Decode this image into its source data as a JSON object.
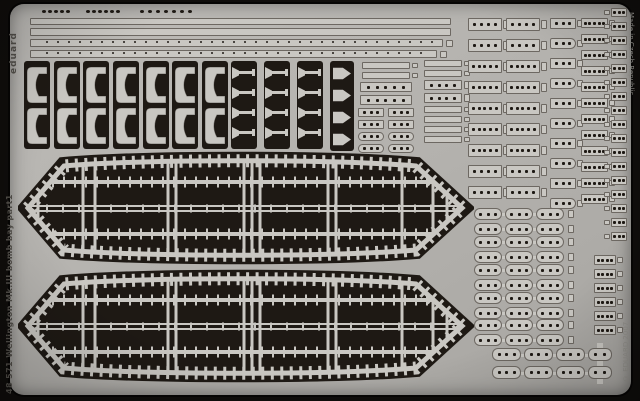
{
  "texts": {
    "brand": "eduard",
    "sheet_label": "48 571  Wellington Mk.III bomb bay   part1",
    "made_in": "Made in Czech Republic",
    "copyright": "© EDUARD 2007"
  },
  "colors": {
    "background": "#0f0d0b",
    "metal": "#b3b1ad",
    "metal_light": "#bdbbb7",
    "metal_dark": "#a7a5a1",
    "part": "#c9c7c2",
    "etch": "#1e1914",
    "outline": "rgba(32,26,20,0.55)",
    "text_dark": "#504d48",
    "text_light": "#8f8d88"
  },
  "parts": {
    "dot_groups": [
      {
        "x": 42,
        "y": 10,
        "count": 5,
        "dx": 6
      },
      {
        "x": 86,
        "y": 10,
        "count": 6,
        "dx": 6
      },
      {
        "x": 140,
        "y": 10,
        "count": 7,
        "dx": 8
      }
    ],
    "strips": [
      {
        "x": 30,
        "y": 18,
        "w": 421,
        "h": 7,
        "ticks": false
      },
      {
        "x": 30,
        "y": 28,
        "w": 421,
        "h": 8,
        "ticks": false
      },
      {
        "x": 30,
        "y": 39,
        "w": 413,
        "h": 8,
        "ticks": true
      },
      {
        "x": 30,
        "y": 50,
        "w": 407,
        "h": 8,
        "ticks": true
      }
    ],
    "end_tabs": [
      {
        "x": 446,
        "y": 40,
        "w": 7,
        "h": 7
      },
      {
        "x": 440,
        "y": 51,
        "w": 7,
        "h": 7
      }
    ],
    "bracket_cols": [
      24,
      54,
      83,
      113,
      143,
      172,
      202
    ],
    "tpin_cols": [
      231,
      264,
      297
    ],
    "arrow_col": {
      "x": 330,
      "y": 61
    },
    "bars": [
      {
        "x": 362,
        "y": 62,
        "w": 48,
        "h": 7,
        "holes": 0,
        "tab": true
      },
      {
        "x": 362,
        "y": 72,
        "w": 48,
        "h": 7,
        "holes": 0,
        "tab": true
      },
      {
        "x": 360,
        "y": 82,
        "w": 52,
        "h": 10,
        "holes": 5,
        "tab": false
      },
      {
        "x": 360,
        "y": 95,
        "w": 52,
        "h": 10,
        "holes": 5,
        "tab": false
      },
      {
        "x": 424,
        "y": 60,
        "w": 38,
        "h": 7,
        "holes": 0,
        "tab": true
      },
      {
        "x": 424,
        "y": 70,
        "w": 38,
        "h": 7,
        "holes": 0,
        "tab": true
      },
      {
        "x": 424,
        "y": 80,
        "w": 38,
        "h": 10,
        "holes": 4,
        "tab": true
      },
      {
        "x": 424,
        "y": 93,
        "w": 38,
        "h": 10,
        "holes": 4,
        "tab": true
      },
      {
        "x": 424,
        "y": 106,
        "w": 38,
        "h": 7,
        "holes": 0,
        "tab": true
      },
      {
        "x": 424,
        "y": 116,
        "w": 38,
        "h": 7,
        "holes": 0,
        "tab": true
      },
      {
        "x": 424,
        "y": 126,
        "w": 38,
        "h": 7,
        "holes": 0,
        "tab": true
      },
      {
        "x": 424,
        "y": 136,
        "w": 38,
        "h": 7,
        "holes": 0,
        "tab": true
      }
    ],
    "small_grid": {
      "x": 358,
      "cols": [
        0,
        30
      ],
      "rows": [
        108,
        120,
        132,
        144
      ],
      "w": 26,
      "h": 9,
      "holes": 3,
      "pill_rows": [
        2,
        3
      ]
    },
    "ladders": [
      {
        "name": "plate-column-1",
        "x": 468,
        "y": 18,
        "rows": 9,
        "pitch": 21,
        "w": 34,
        "h": 13,
        "holes": [
          4,
          4,
          5,
          5,
          5,
          5,
          5,
          4,
          4
        ],
        "shape": "rect",
        "tab": true
      },
      {
        "name": "plate-column-2",
        "x": 506,
        "y": 18,
        "rows": 9,
        "pitch": 21,
        "w": 34,
        "h": 13,
        "holes": [
          4,
          4,
          5,
          5,
          5,
          5,
          5,
          4,
          4
        ],
        "shape": "rect",
        "tab": true
      },
      {
        "name": "bullet-column",
        "x": 550,
        "y": 18,
        "rows": 10,
        "pitch": 20,
        "w": 26,
        "h": 11,
        "holes": 3,
        "shape": "alt",
        "tab": true
      },
      {
        "name": "ladder-right",
        "x": 581,
        "y": 18,
        "rows": 12,
        "pitch": 16,
        "w": 27,
        "h": 10,
        "holes": 5,
        "shape": "rect",
        "tab": true
      },
      {
        "name": "ladder-far-right",
        "x": 611,
        "y": 8,
        "rows": 17,
        "pitch": 14,
        "w": 16,
        "h": 9,
        "holes": 3,
        "shape": "rect",
        "tab": true,
        "tabLeft": true
      },
      {
        "name": "ladder-lower-right",
        "x": 594,
        "y": 255,
        "rows": 6,
        "pitch": 14,
        "w": 22,
        "h": 10,
        "holes": 4,
        "shape": "rect",
        "tab": true
      }
    ],
    "chain_cfg": {
      "links": 3,
      "lw": 28,
      "lh": 12,
      "row_gap": 15,
      "holes": 3
    },
    "chain_groups": [
      {
        "x": 474,
        "y": 208
      },
      {
        "x": 474,
        "y": 236
      },
      {
        "x": 474,
        "y": 264
      },
      {
        "x": 474,
        "y": 292
      },
      {
        "x": 474,
        "y": 319
      }
    ],
    "long_cfg": {
      "links": 3,
      "lw": 29,
      "lh": 13,
      "holes": 3,
      "plus": true
    },
    "long_chains": [
      {
        "x": 492,
        "y": 348
      },
      {
        "x": 492,
        "y": 366
      }
    ],
    "doors": {
      "x": 18,
      "ys": [
        149,
        267
      ],
      "w": 456,
      "h": 118,
      "outline": "M10,59 L46,17 C130,10 314,10 398,17 L444,59 L398,101 C314,108 130,108 46,101 Z",
      "ribs": [
        [
          20
        ],
        [
          65,
          77
        ],
        [
          150,
          158
        ],
        [
          226,
          234,
          242
        ],
        [
          310,
          318
        ],
        [
          384
        ],
        [
          415,
          429
        ]
      ],
      "chords": [
        33,
        85
      ],
      "center": [
        57,
        62
      ]
    }
  }
}
